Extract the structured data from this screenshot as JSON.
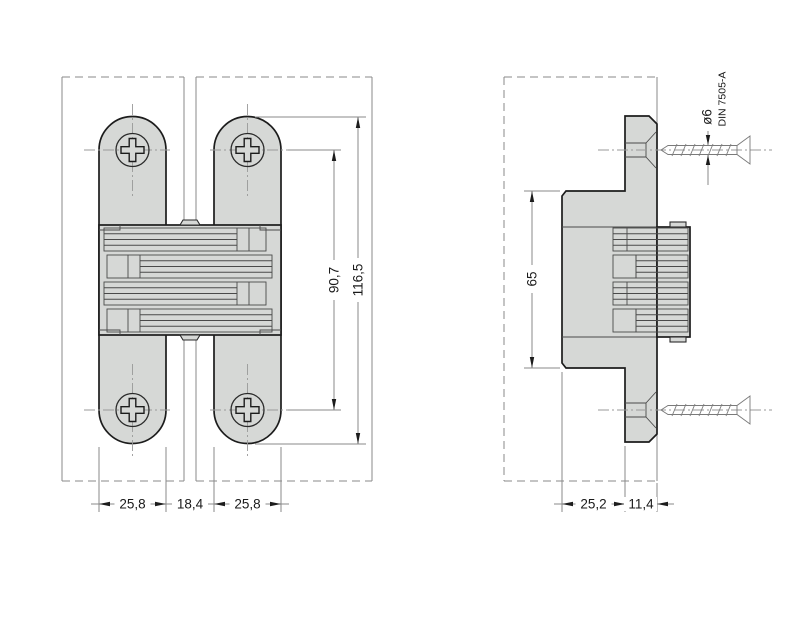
{
  "front_view": {
    "dims": {
      "left_plate_width": "25,8",
      "center_gap": "18,4",
      "right_plate_width": "25,8",
      "hole_spacing": "90,7",
      "overall_length": "116,5"
    }
  },
  "side_view": {
    "dims": {
      "body_height": "65",
      "body_depth": "25,2",
      "faceplate_depth": "11,4"
    },
    "screw_callout": {
      "diameter": "ø6",
      "standard": "DIN 7505-A"
    }
  },
  "colors": {
    "background": "#ffffff",
    "part_fill": "#d6d8d6",
    "outline": "#1c1c1c",
    "detail_line": "#4a4a4a",
    "construction_line": "#8a8a8a",
    "dimension_text": "#1a1a1a"
  }
}
